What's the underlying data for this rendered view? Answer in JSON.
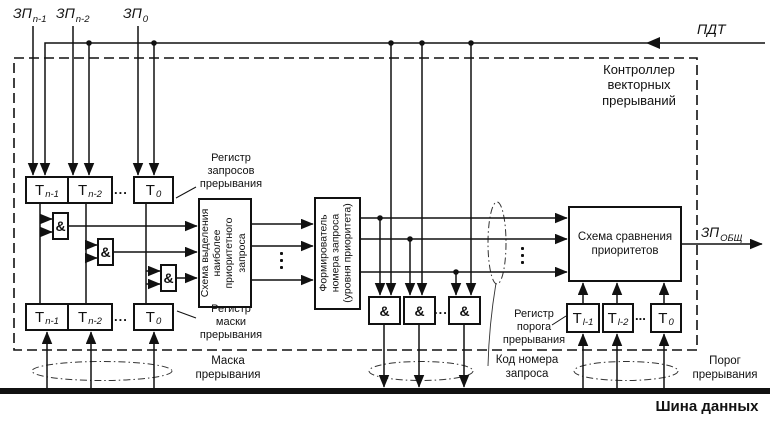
{
  "inputs": {
    "zp": [
      {
        "base": "ЗП",
        "sub": "n-1"
      },
      {
        "base": "ЗП",
        "sub": "n-2"
      },
      {
        "base": "ЗП",
        "sub": "0"
      }
    ],
    "pdt": "ПДТ"
  },
  "controller": {
    "lines": [
      "Контроллер",
      "векторных",
      "прерываний"
    ]
  },
  "request_register": {
    "label_lines": [
      "Регистр",
      "запросов",
      "прерывания"
    ],
    "cells": [
      {
        "base": "Т",
        "sub": "n-1"
      },
      {
        "base": "Т",
        "sub": "n-2"
      },
      {
        "base": "Т",
        "sub": "0"
      }
    ],
    "dots": "..."
  },
  "mask_register": {
    "label_lines": [
      "Регистр",
      "маски",
      "прерывания"
    ],
    "cells": [
      {
        "base": "Т",
        "sub": "n-1"
      },
      {
        "base": "Т",
        "sub": "n-2"
      },
      {
        "base": "Т",
        "sub": "0"
      }
    ],
    "dots": "..."
  },
  "threshold_register": {
    "label_lines": [
      "Регистр",
      "порога",
      "прерывания"
    ],
    "cells": [
      {
        "base": "Т",
        "sub": "l-1"
      },
      {
        "base": "Т",
        "sub": "l-2"
      },
      {
        "base": "Т",
        "sub": "0"
      }
    ],
    "dots": "..."
  },
  "gates": {
    "and": "&",
    "dots": "..."
  },
  "blocks": {
    "priority_selector": {
      "lines": [
        "Схема выделения",
        "наиболее",
        "приоритетного",
        "запроса"
      ]
    },
    "number_former": {
      "lines": [
        "Формирователь",
        "номера запроса",
        "(уровня приоритета)"
      ]
    },
    "comparator": {
      "lines": [
        "Схема сравнения",
        "приоритетов"
      ]
    }
  },
  "output": {
    "zp_common": {
      "base": "ЗП",
      "sub": "ОБЩ"
    }
  },
  "annotations": {
    "mask_lines": [
      "Маска",
      "прерывания"
    ],
    "code_lines": [
      "Код номера",
      "запроса"
    ],
    "threshold_lines": [
      "Порог",
      "прерывания"
    ],
    "bus": "Шина данных"
  }
}
